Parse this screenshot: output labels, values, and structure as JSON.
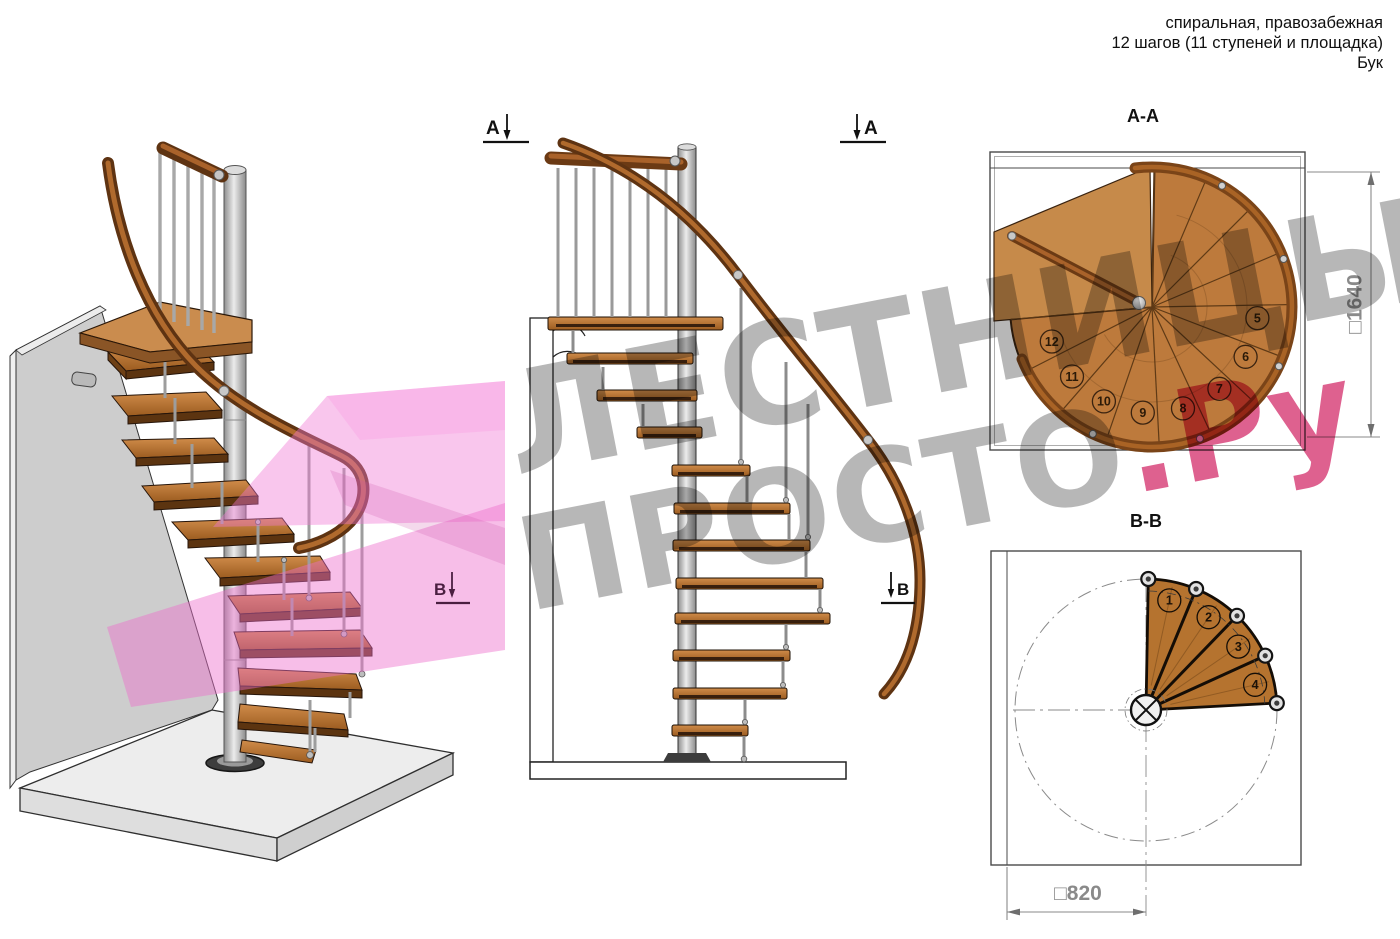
{
  "header": {
    "line1": "спиральная, правозабежная",
    "line2": "12 шагов (11 ступеней и площадка)",
    "line3": "Бук"
  },
  "watermark": {
    "top": "ЛЕСТНИЦЫ",
    "bottom_gray": "ПРОСТО",
    "bottom_red": ".Ру"
  },
  "plans": {
    "aa": {
      "title": "А-А",
      "dimension_label": "□1640",
      "steps": [
        "5",
        "6",
        "7",
        "8",
        "9",
        "10",
        "11",
        "12"
      ]
    },
    "bb": {
      "title": "В-В",
      "dimension_label": "□820",
      "steps": [
        "1",
        "2",
        "3",
        "4"
      ]
    }
  },
  "section_markers": {
    "a": "А",
    "b": "В"
  },
  "colors": {
    "wood": "#c08040",
    "wood_dark": "#6e4015",
    "handrail": "#6b3a14",
    "steel": "#c0c0c0",
    "section_plane_pink": "#ee7fd0",
    "watermark_gray": "#9a9a9a",
    "watermark_red": "#d53470",
    "dimension_gray": "#8a8a8a",
    "outline": "#262626"
  }
}
